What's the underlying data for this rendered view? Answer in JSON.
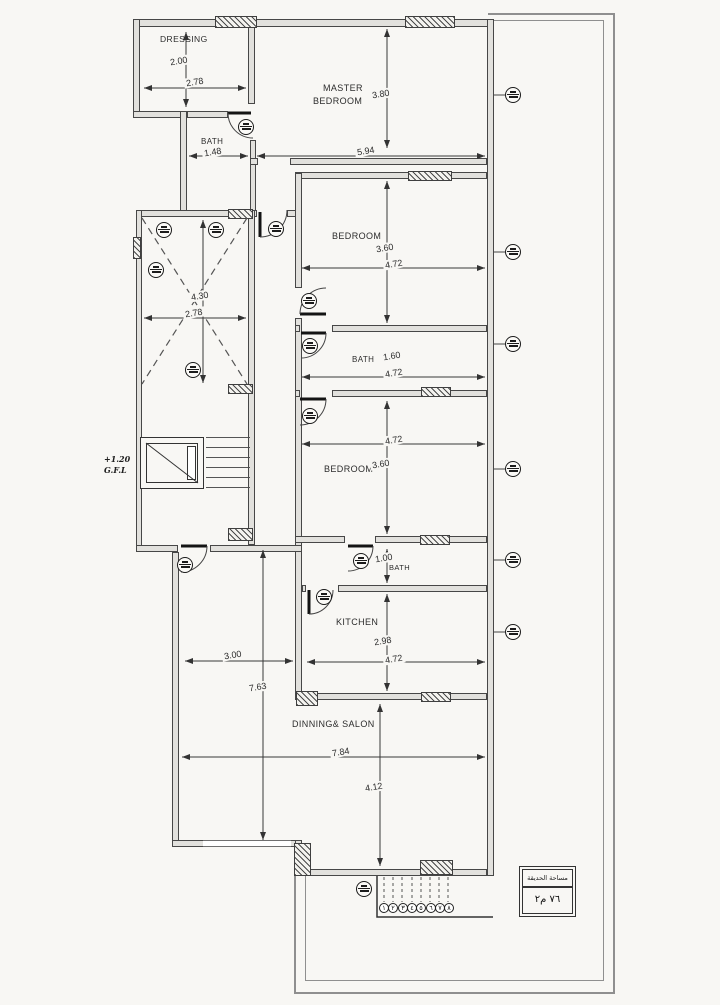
{
  "rooms": {
    "dressing": "DRESSING",
    "master_line1": "MASTER",
    "master_line2": "BEDROOM",
    "bath_top": "BATH",
    "bedroom1": "BEDROOM",
    "bath_mid": "BATH",
    "bedroom2": "BEDROOM",
    "bath_small": "BATH",
    "kitchen": "KITCHEN",
    "dining_salon": "DINNING& SALON"
  },
  "dims": {
    "dressing_depth": "2.00",
    "dressing_width": "2.78",
    "bath_top_width": "1.48",
    "master_depth": "3.80",
    "master_width": "5.94",
    "bedroom1_depth": "3.60",
    "bedroom1_width": "4.72",
    "shaft_depth": "4.30",
    "shaft_width": "2.78",
    "bath_mid_depth": "1.60",
    "bath_mid_width": "4.72",
    "bedroom2_width": "4.72",
    "bedroom2_depth": "3.60",
    "bath_small_depth": "1.00",
    "kitchen_depth": "2.98",
    "kitchen_width": "4.72",
    "side_yard_width": "3.00",
    "side_yard_depth": "7.63",
    "salon_width": "7.84",
    "salon_depth": "4.12"
  },
  "level_note": {
    "line1": "+1.20",
    "line2": "G.F.L"
  },
  "entrance_steps": [
    "١",
    "٢",
    "٣",
    "٤",
    "٥",
    "٦",
    "٧",
    "٨"
  ],
  "garden_box": {
    "title": "مساحة الحديقة",
    "value": "٧٦ م٢"
  }
}
